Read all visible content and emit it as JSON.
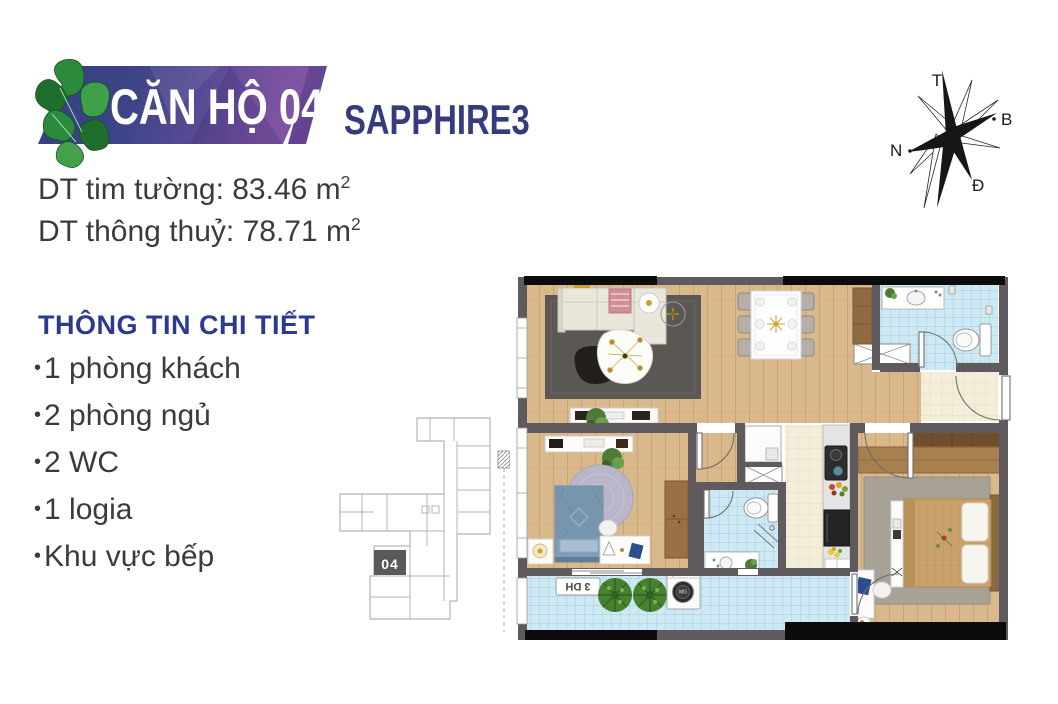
{
  "banner": {
    "title": "CĂN HỘ 04",
    "project": "SAPPHIRE3",
    "accent_navy": "#363a7e",
    "gradient_from": "#32407f",
    "gradient_to": "#8859a8"
  },
  "areas": [
    {
      "label": "DT tim tường:",
      "value": "83.46",
      "unit": "m",
      "sup": "2"
    },
    {
      "label": "DT thông thuỷ:",
      "value": "78.71",
      "unit": "m",
      "sup": "2"
    }
  ],
  "details": {
    "heading": "THÔNG TIN CHI TIẾT",
    "items": [
      "1 phòng khách",
      "2 phòng ngủ",
      "2 WC",
      "1 logia",
      "Khu vực bếp"
    ]
  },
  "keyplan": {
    "unit_label": "04"
  },
  "compass": {
    "top": "T",
    "right": "B",
    "left": "N",
    "bottom": "Đ"
  },
  "floorplan": {
    "balcony_unit_label": "3 DH",
    "washer_label": "MG"
  },
  "colors": {
    "wall": "#5f5a5d",
    "wood": "#d9b88c",
    "tile_blue": "#cde9f4",
    "tile_beige": "#f3edd9",
    "heading_navy": "#2b3a90",
    "text": "#3c3b3b",
    "keyplan_unit_bg": "#58595b"
  }
}
